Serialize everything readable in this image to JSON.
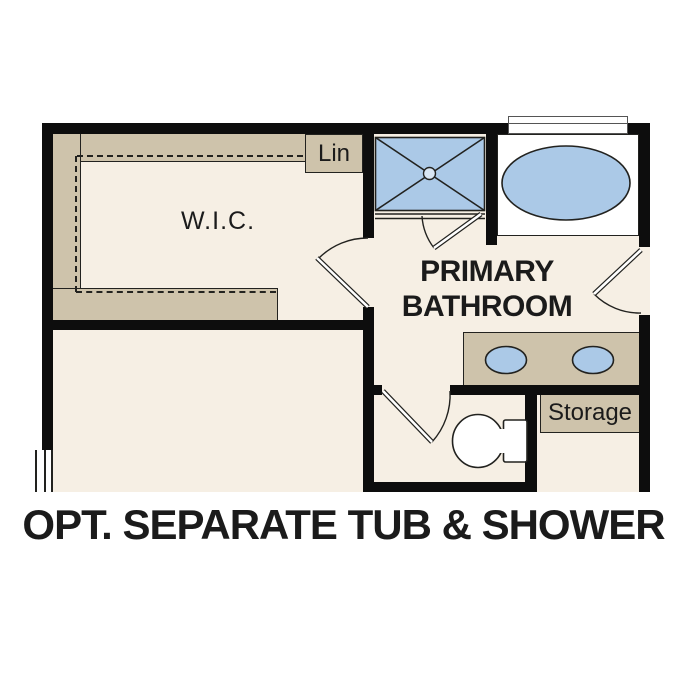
{
  "caption": "OPT. SEPARATE TUB & SHOWER",
  "rooms": {
    "wic": {
      "label": "W.I.C."
    },
    "linen": {
      "label": "Lin"
    },
    "bathroom": {
      "label_line1": "PRIMARY",
      "label_line2": "BATHROOM"
    },
    "storage": {
      "label": "Storage"
    }
  },
  "fixtures": {
    "shower": "walk-in shower with drain",
    "tub": "oval soaking tub",
    "vanity": "double-sink vanity",
    "toilet": "toilet in water closet",
    "windows": "tub window, bedroom window"
  },
  "colors": {
    "floor": "#f6efe4",
    "cabinet": "#cec3ab",
    "fixture": "#abc9e7",
    "wall": "#0d0d0d",
    "line": "#22221f",
    "text": "#1b1b1b",
    "windowline": "#555555"
  }
}
